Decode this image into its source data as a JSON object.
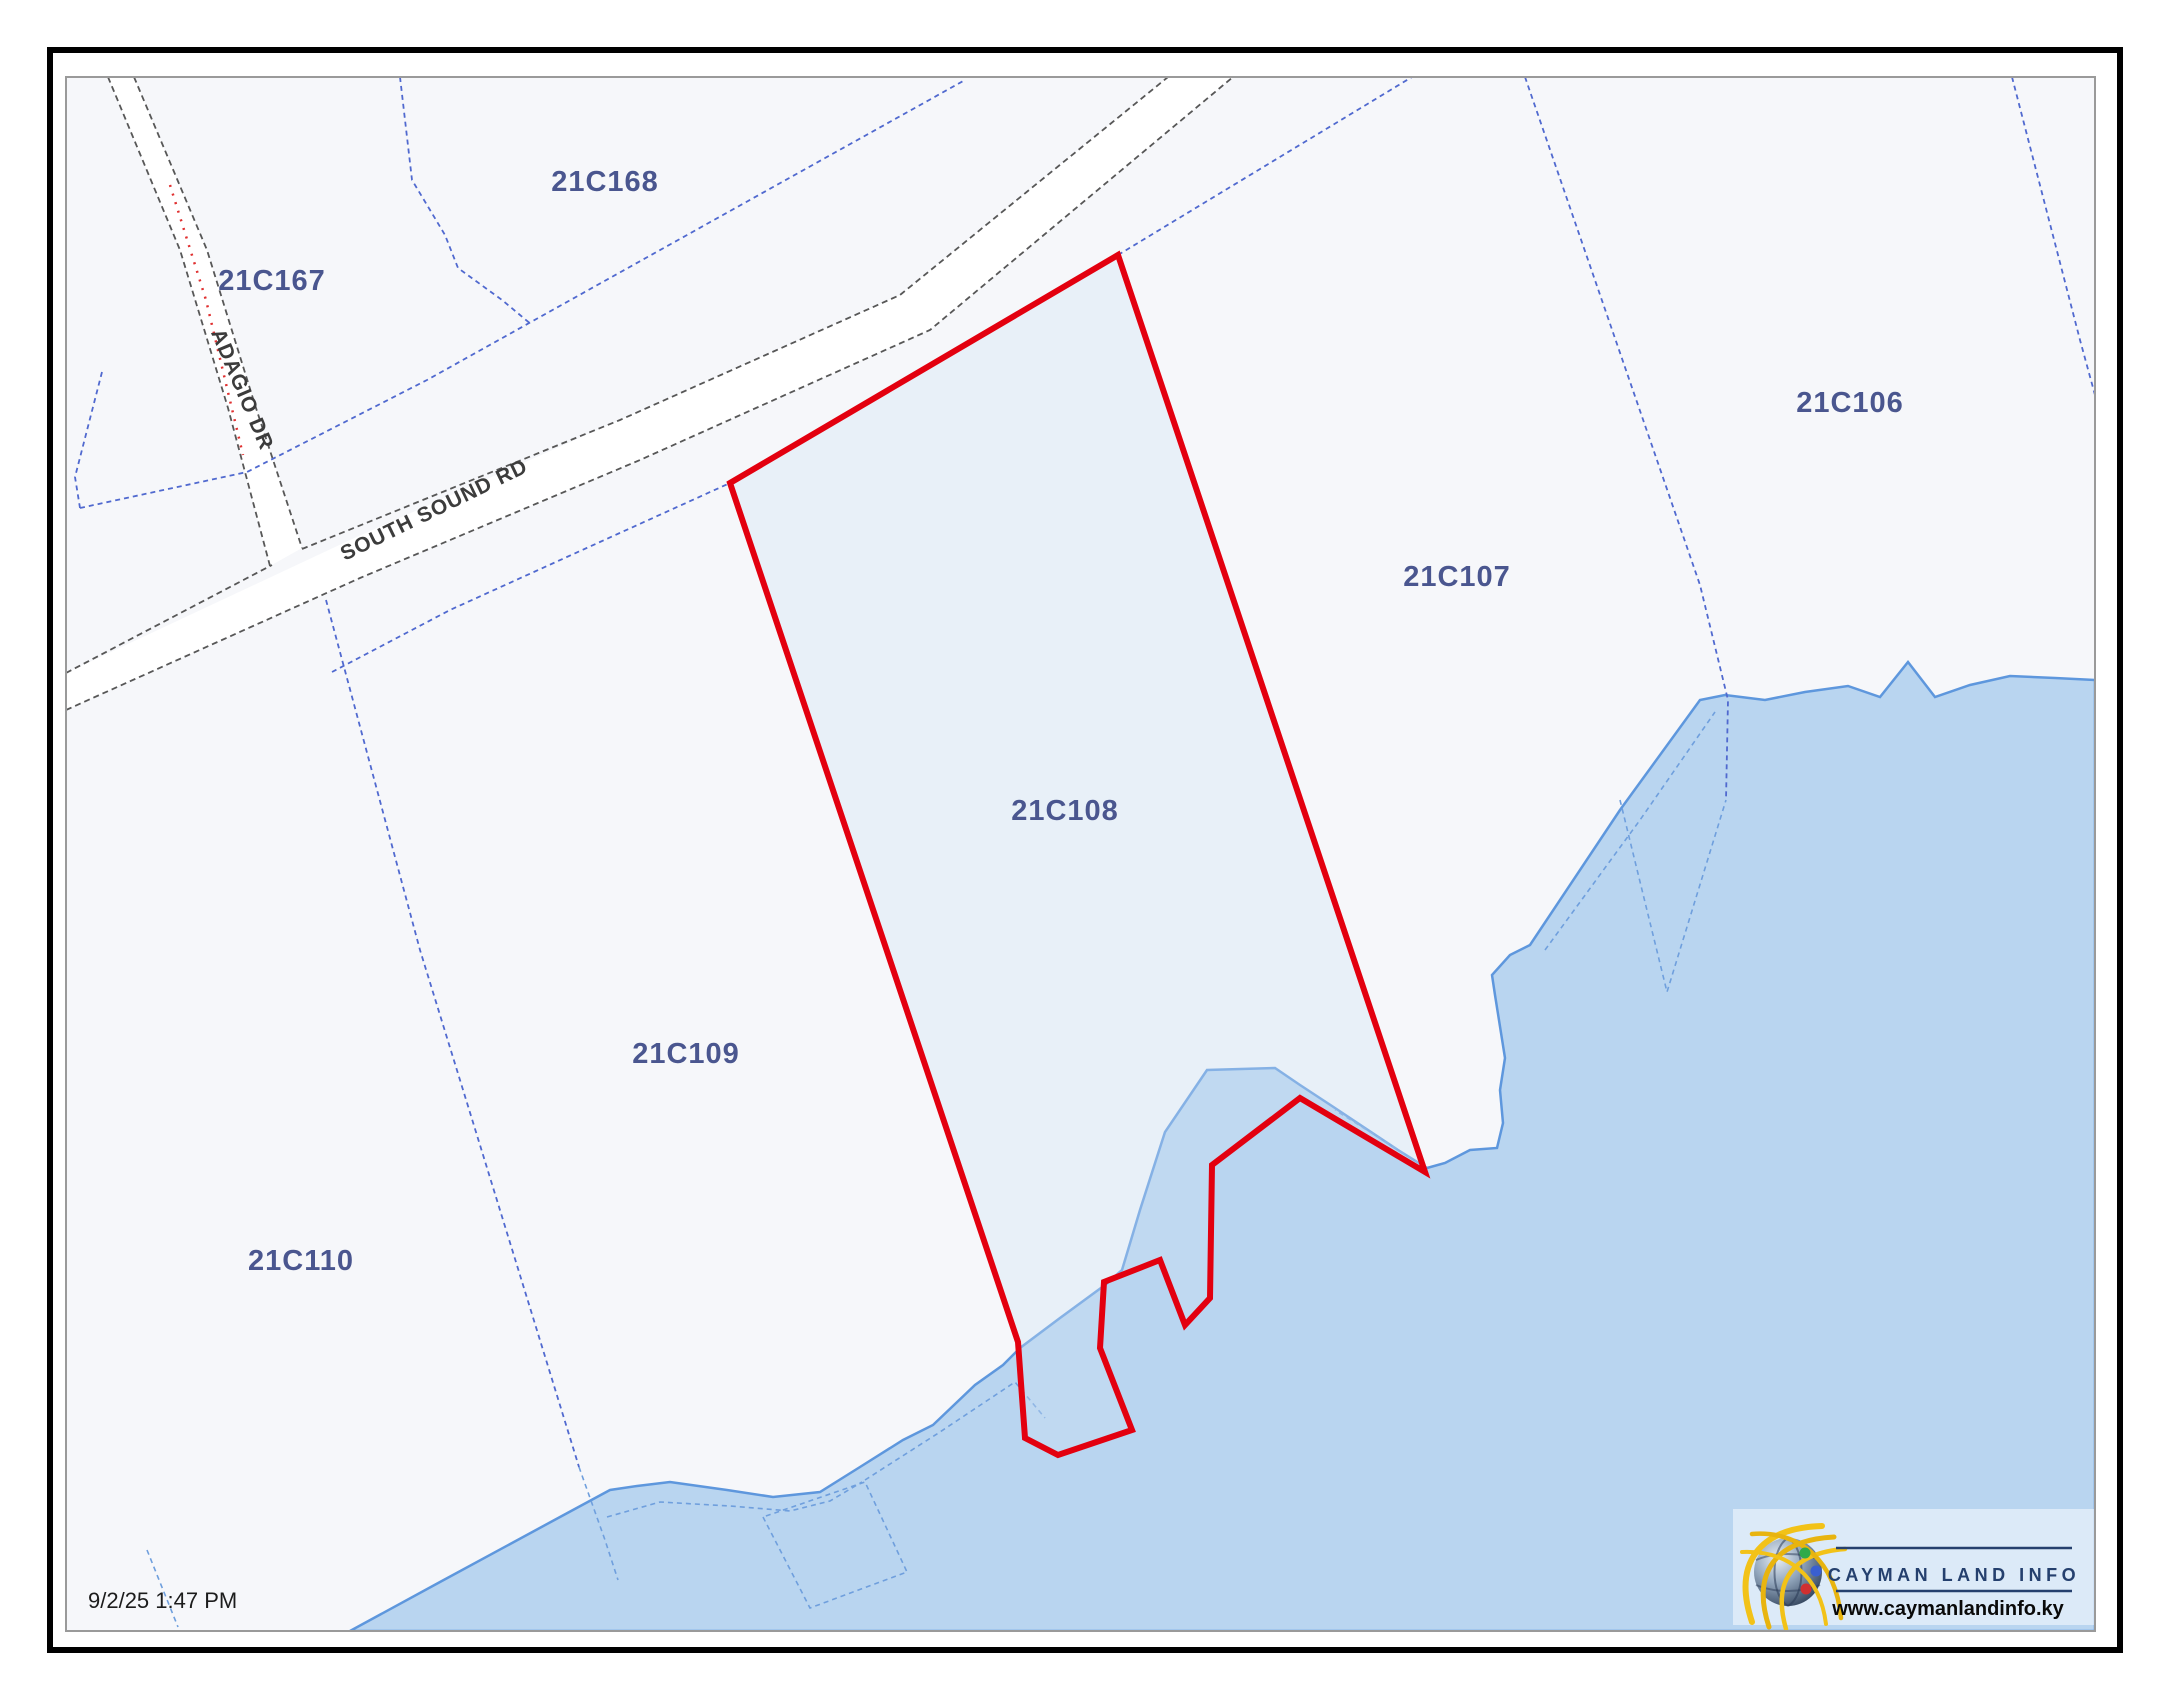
{
  "map": {
    "timestamp": "9/2/25 1:47 PM",
    "selected_parcel": "21C108",
    "parcels": [
      {
        "id": "21C167"
      },
      {
        "id": "21C168"
      },
      {
        "id": "21C106"
      },
      {
        "id": "21C107"
      },
      {
        "id": "21C108"
      },
      {
        "id": "21C109"
      },
      {
        "id": "21C110"
      }
    ],
    "roads": [
      {
        "name": "SOUTH SOUND RD"
      },
      {
        "name": "ADAGIO DR"
      }
    ],
    "logo": {
      "brand": "CAYMAN LAND INFO",
      "url": "www.caymanlandinfo.ky"
    },
    "colors": {
      "selected_outline": "#e3000f",
      "selected_fill": "rgba(205,225,243,0.35)",
      "water_fill": "#b9d5f0",
      "coast_line": "#5e97dd",
      "boundary_blue": "#5069cf",
      "label_blue": "#4a568f",
      "road_dash": "#575757",
      "land": "#f6f7fa"
    }
  }
}
